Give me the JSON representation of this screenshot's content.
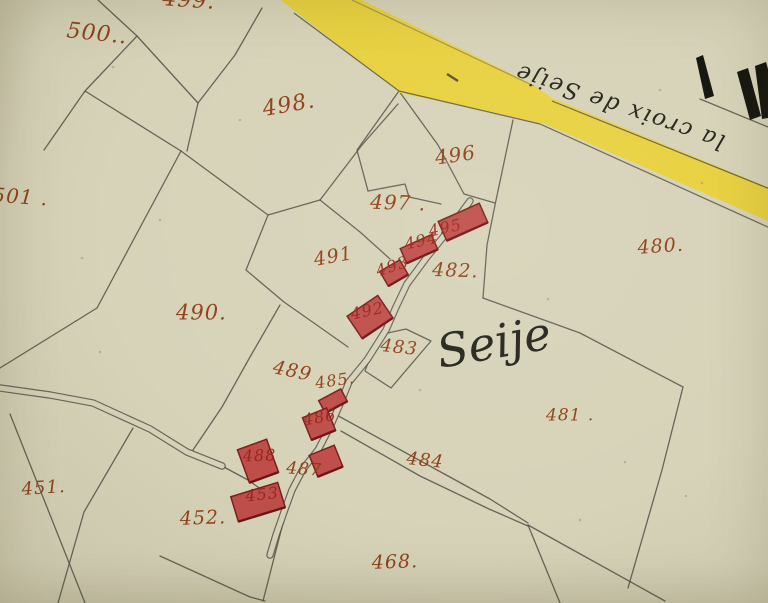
{
  "map": {
    "type": "cadastral-map",
    "place_label": "Seije",
    "road_inscription": "la croix de Seije",
    "colors": {
      "paper": "#d7d3b9",
      "line": "#56544a",
      "road_yellow": "#e9d138",
      "building_fill": "#bf4e4a",
      "building_stroke": "#7c1f1c",
      "building_shade": "#6e1512",
      "number_rust": "#8d3a10",
      "number_crimson": "#9c221a",
      "ink": "#26251c"
    },
    "parcel_labels": [
      {
        "text": "500..",
        "x": 66,
        "y": 20,
        "rot": 6,
        "size": 22
      },
      {
        "text": "499.",
        "x": 162,
        "y": -12,
        "rot": 4,
        "size": 22
      },
      {
        "text": "501 .",
        "x": -8,
        "y": 186,
        "rot": 4,
        "size": 20
      },
      {
        "text": "498.",
        "x": 264,
        "y": 99,
        "rot": -10,
        "size": 22
      },
      {
        "text": "496",
        "x": 436,
        "y": 149,
        "rot": -8,
        "size": 20
      },
      {
        "text": "497 .",
        "x": 370,
        "y": 193,
        "rot": 2,
        "size": 20
      },
      {
        "text": "482.",
        "x": 432,
        "y": 261,
        "rot": 2,
        "size": 19
      },
      {
        "text": "480.",
        "x": 638,
        "y": 239,
        "rot": -4,
        "size": 19
      },
      {
        "text": "491",
        "x": 315,
        "y": 251,
        "rot": -10,
        "size": 19
      },
      {
        "text": "490.",
        "x": 176,
        "y": 303,
        "rot": 0,
        "size": 21
      },
      {
        "text": "483",
        "x": 380,
        "y": 337,
        "rot": 6,
        "size": 18
      },
      {
        "text": "489",
        "x": 272,
        "y": 358,
        "rot": 12,
        "size": 19
      },
      {
        "text": "481 .",
        "x": 546,
        "y": 407,
        "rot": 0,
        "size": 17
      },
      {
        "text": "484",
        "x": 406,
        "y": 450,
        "rot": 6,
        "size": 18
      },
      {
        "text": "485.",
        "x": 316,
        "y": 376,
        "rot": -8,
        "size": 16
      },
      {
        "text": "487",
        "x": 286,
        "y": 460,
        "rot": 4,
        "size": 17
      },
      {
        "text": "451.",
        "x": 22,
        "y": 481,
        "rot": -4,
        "size": 18
      },
      {
        "text": "452.",
        "x": 180,
        "y": 510,
        "rot": -2,
        "size": 19
      },
      {
        "text": "468.",
        "x": 372,
        "y": 554,
        "rot": -2,
        "size": 19
      }
    ],
    "building_labels": [
      {
        "text": "495",
        "x": 430,
        "y": 224,
        "rot": -12,
        "size": 16
      },
      {
        "text": "494",
        "x": 406,
        "y": 237,
        "rot": -12,
        "size": 16
      },
      {
        "text": "493",
        "x": 378,
        "y": 264,
        "rot": -18,
        "size": 16
      },
      {
        "text": "492",
        "x": 352,
        "y": 307,
        "rot": -12,
        "size": 16
      },
      {
        "text": "486",
        "x": 304,
        "y": 413,
        "rot": -10,
        "size": 16
      },
      {
        "text": "488",
        "x": 243,
        "y": 449,
        "rot": -2,
        "size": 16
      },
      {
        "text": "453",
        "x": 246,
        "y": 489,
        "rot": -6,
        "size": 16
      }
    ],
    "buildings": [
      {
        "cx": 463,
        "cy": 222,
        "w": 45,
        "h": 21,
        "rot": -24
      },
      {
        "cx": 419,
        "cy": 249,
        "w": 34,
        "h": 16,
        "rot": -24
      },
      {
        "cx": 394,
        "cy": 273,
        "w": 23,
        "h": 17,
        "rot": -30
      },
      {
        "cx": 370,
        "cy": 317,
        "w": 37,
        "h": 27,
        "rot": -34
      },
      {
        "cx": 333,
        "cy": 401,
        "w": 25,
        "h": 14,
        "rot": -28
      },
      {
        "cx": 319,
        "cy": 424,
        "w": 26,
        "h": 24,
        "rot": -22
      },
      {
        "cx": 326,
        "cy": 461,
        "w": 27,
        "h": 23,
        "rot": -22
      },
      {
        "cx": 258,
        "cy": 461,
        "w": 31,
        "h": 35,
        "rot": -20
      },
      {
        "cx": 258,
        "cy": 502,
        "w": 49,
        "h": 26,
        "rot": -17
      }
    ],
    "boundaries": [
      [
        [
          98,
          0
        ],
        [
          137,
          36
        ],
        [
          85,
          91
        ],
        [
          44,
          150
        ]
      ],
      [
        [
          85,
          91
        ],
        [
          181,
          151
        ]
      ],
      [
        [
          137,
          36
        ],
        [
          198,
          103
        ],
        [
          187,
          151
        ]
      ],
      [
        [
          181,
          151
        ],
        [
          97,
          308
        ],
        [
          0,
          368
        ]
      ],
      [
        [
          181,
          151
        ],
        [
          268,
          215
        ],
        [
          320,
          200
        ]
      ],
      [
        [
          268,
          215
        ],
        [
          246,
          270
        ],
        [
          284,
          302
        ],
        [
          348,
          347
        ]
      ],
      [
        [
          320,
          200
        ],
        [
          362,
          145
        ],
        [
          398,
          104
        ]
      ],
      [
        [
          320,
          200
        ],
        [
          360,
          232
        ],
        [
          390,
          259
        ]
      ],
      [
        [
          262,
          8
        ],
        [
          235,
          55
        ],
        [
          198,
          103
        ]
      ],
      [
        [
          399,
          91
        ],
        [
          357,
          150
        ],
        [
          368,
          191
        ]
      ],
      [
        [
          399,
          91
        ],
        [
          438,
          145
        ],
        [
          464,
          194
        ]
      ],
      [
        [
          368,
          191
        ],
        [
          405,
          184
        ],
        [
          409,
          197
        ],
        [
          441,
          204
        ]
      ],
      [
        [
          464,
          194
        ],
        [
          495,
          203
        ]
      ],
      [
        [
          513,
          120
        ],
        [
          495,
          205
        ],
        [
          487,
          245
        ],
        [
          483,
          298
        ]
      ],
      [
        [
          483,
          298
        ],
        [
          580,
          333
        ],
        [
          683,
          387
        ],
        [
          662,
          470
        ],
        [
          628,
          588
        ]
      ],
      [
        [
          383,
          334
        ],
        [
          406,
          329
        ],
        [
          431,
          341
        ],
        [
          391,
          388
        ],
        [
          365,
          371
        ],
        [
          372,
          352
        ],
        [
          383,
          334
        ]
      ],
      [
        [
          280,
          305
        ],
        [
          250,
          357
        ],
        [
          222,
          407
        ],
        [
          193,
          450
        ]
      ],
      [
        [
          333,
          413
        ],
        [
          417,
          459
        ],
        [
          490,
          499
        ],
        [
          528,
          523
        ]
      ],
      [
        [
          341,
          431
        ],
        [
          420,
          476
        ],
        [
          489,
          509
        ],
        [
          528,
          526
        ]
      ],
      [
        [
          528,
          525
        ],
        [
          665,
          601
        ]
      ],
      [
        [
          528,
          525
        ],
        [
          560,
          603
        ]
      ],
      [
        [
          160,
          556
        ],
        [
          250,
          597
        ],
        [
          265,
          601
        ]
      ],
      [
        [
          283,
          523
        ],
        [
          263,
          601
        ]
      ],
      [
        [
          10,
          414
        ],
        [
          85,
          603
        ]
      ],
      [
        [
          133,
          428
        ],
        [
          84,
          512
        ],
        [
          58,
          603
        ]
      ],
      [
        [
          700,
          99
        ],
        [
          768,
          127
        ]
      ],
      [
        [
          222,
          466
        ],
        [
          248,
          480
        ],
        [
          272,
          497
        ]
      ]
    ],
    "dirt_roads": [
      [
        [
          470,
          201
        ],
        [
          448,
          231
        ],
        [
          427,
          257
        ],
        [
          407,
          284
        ],
        [
          396,
          307
        ],
        [
          386,
          330
        ],
        [
          367,
          360
        ],
        [
          349,
          382
        ],
        [
          340,
          404
        ],
        [
          330,
          427
        ],
        [
          318,
          450
        ],
        [
          303,
          469
        ],
        [
          292,
          490
        ],
        [
          284,
          512
        ],
        [
          276,
          535
        ],
        [
          270,
          555
        ]
      ],
      [
        [
          0,
          388
        ],
        [
          50,
          395
        ],
        [
          93,
          403
        ],
        [
          150,
          429
        ],
        [
          187,
          452
        ],
        [
          222,
          466
        ]
      ]
    ],
    "yellow_road": {
      "polygon": [
        [
          350,
          -6
        ],
        [
          534,
          85
        ],
        [
          552,
          98
        ],
        [
          775,
          190
        ],
        [
          775,
          224
        ],
        [
          545,
          124
        ],
        [
          400,
          93
        ],
        [
          273,
          -6
        ]
      ],
      "casings": [
        [
          [
            294,
            13
          ],
          [
            399,
            91
          ],
          [
            540,
            124
          ],
          [
            770,
            228
          ]
        ],
        [
          [
            552,
            101
          ],
          [
            770,
            189
          ]
        ],
        [
          [
            352,
            0
          ],
          [
            534,
            86
          ]
        ]
      ],
      "dash_mark": [
        [
          447,
          74
        ],
        [
          458,
          81
        ]
      ]
    },
    "cross_marks": [
      [
        [
          696,
          58
        ],
        [
          703,
          55
        ],
        [
          714,
          96
        ],
        [
          705,
          99
        ]
      ],
      [
        [
          737,
          72
        ],
        [
          748,
          68
        ],
        [
          761,
          116
        ],
        [
          750,
          120
        ]
      ],
      [
        [
          755,
          66
        ],
        [
          766,
          62
        ],
        [
          768,
          69
        ],
        [
          768,
          118
        ],
        [
          762,
          119
        ]
      ]
    ],
    "speckles": [
      [
        113,
        67
      ],
      [
        240,
        120
      ],
      [
        548,
        299
      ],
      [
        100,
        352
      ],
      [
        686,
        496
      ],
      [
        625,
        462
      ],
      [
        82,
        258
      ],
      [
        660,
        90
      ],
      [
        702,
        183
      ],
      [
        420,
        390
      ],
      [
        160,
        220
      ],
      [
        580,
        520
      ]
    ],
    "script_texts": {
      "seije": {
        "x": 440,
        "y": 368,
        "rot": -10,
        "size": 46
      },
      "croix": {
        "x": 622,
        "y": 100,
        "rot": 199,
        "size": 23
      }
    }
  }
}
